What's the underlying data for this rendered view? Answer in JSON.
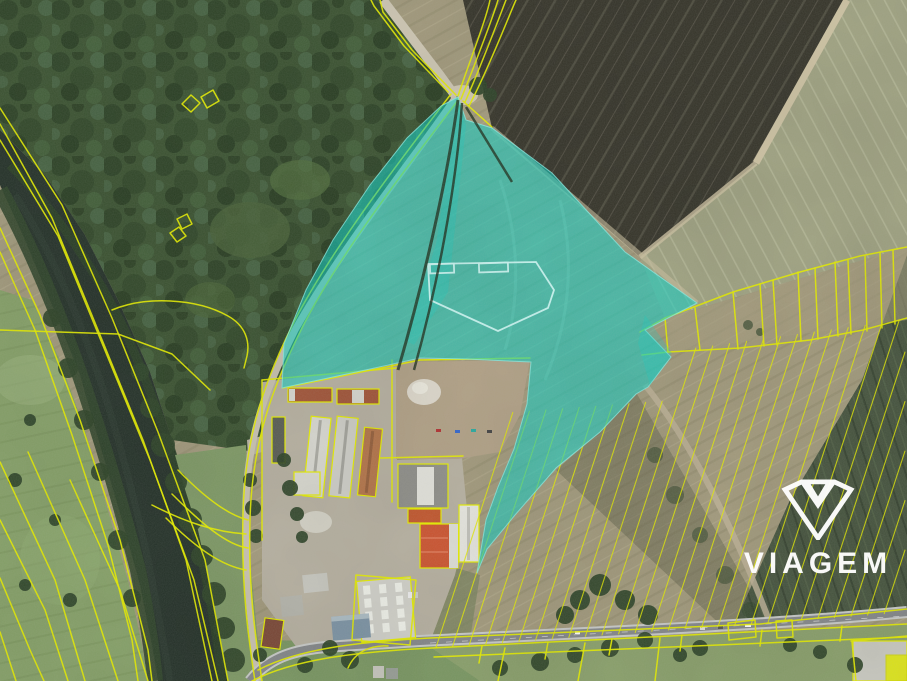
{
  "watermark": {
    "brand": "VIAGEM",
    "icon": "viagem-gem-icon"
  },
  "colors": {
    "highlight_fill": "#0fd2c6",
    "highlight_inner_outline": "#cdf8f3",
    "cadastral_yellow": "#e6ee00",
    "watermark_white": "#ffffff"
  }
}
